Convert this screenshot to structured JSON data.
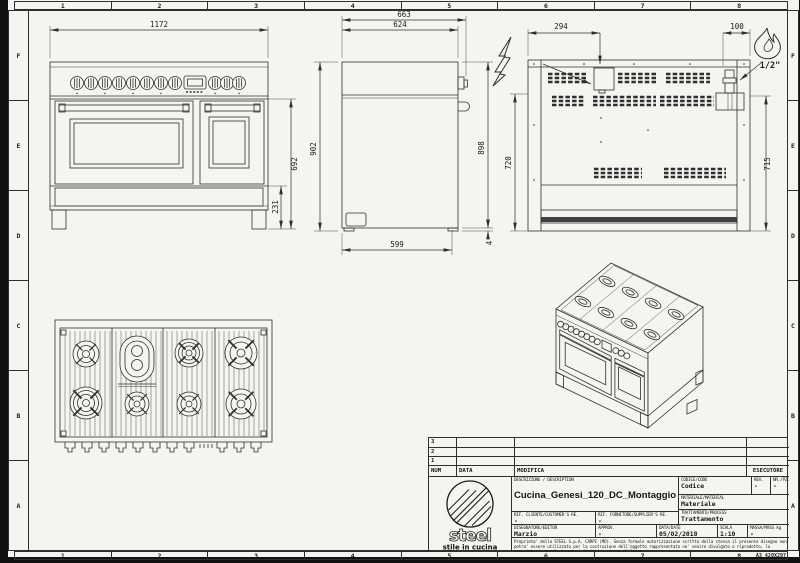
{
  "sheet": {
    "grid_columns": [
      "1",
      "2",
      "3",
      "4",
      "5",
      "6",
      "7",
      "8"
    ],
    "grid_rows": [
      "F",
      "E",
      "D",
      "C",
      "B",
      "A"
    ],
    "format_label": "A3 420X297"
  },
  "views": {
    "front": {
      "dim_width": "1172",
      "dim_body_height": "692",
      "dim_plinth_height": "231"
    },
    "side": {
      "dim_depth_total": "663",
      "dim_depth_body": "624",
      "dim_height_total": "902",
      "dim_height_right": "898",
      "dim_depth_base": "599",
      "dim_foot_gap": "4"
    },
    "rear": {
      "dim_electric_offset": "294",
      "dim_gas_offset": "100",
      "dim_height_left": "720",
      "dim_height_right": "715",
      "gas_thread": "1/2\""
    }
  },
  "title_block": {
    "revisions": {
      "row_numbers": [
        "3",
        "2",
        "1"
      ],
      "headers": {
        "num": "NUM",
        "data": "DATA",
        "modifica": "MODIFICA",
        "esecutore": "ESECUTORE"
      }
    },
    "logo": {
      "brand": "steel",
      "tagline": "stile in cucina"
    },
    "description": {
      "label": "DESCRIZIONE / DESCRIPTION",
      "value": "Cucina_Genesi_120_DC_Montaggio"
    },
    "codice": {
      "label": "CODICE/CODE",
      "value": "Codice"
    },
    "rev": {
      "label": "REV.",
      "value": "-"
    },
    "nr_pz": {
      "label": "NR./PZ.",
      "value": "-"
    },
    "materiale": {
      "label": "MATERIALE/MATERIAL",
      "value": "Materiale"
    },
    "trattamento": {
      "label": "TRATTAMENTO/PROCESS",
      "value": "Trattamento"
    },
    "rif_cliente": {
      "label": "RIF. CLIENTE/CUSTOMER'S RE.",
      "value": "-"
    },
    "rif_fornitore": {
      "label": "RIF. FORNITORE/SUPPLIER'S RE.",
      "value": "-"
    },
    "disegnatore": {
      "label": "DISEGNATORE/EDITOR",
      "value": "Marzio"
    },
    "approv": {
      "label": "APPROV.",
      "value": "-"
    },
    "data": {
      "label": "DATA/DATE",
      "value": "05/02/2018"
    },
    "scala": {
      "label": "SCALA",
      "value": "1:10"
    },
    "massa": {
      "label": "MASSA/MASS kg",
      "value": "-"
    },
    "disclaimer": "Proprieta' della STEEL S.p.A. CARPI (MO). Senza formale autorizzazione scritta della stessa il presente disegno non potra' essere utilizzato per la costruzione dell'oggetto rappresentato ne' venire divulgato o riprodotto, la proprietaria tutela i propri diritti a rigore di legge."
  }
}
